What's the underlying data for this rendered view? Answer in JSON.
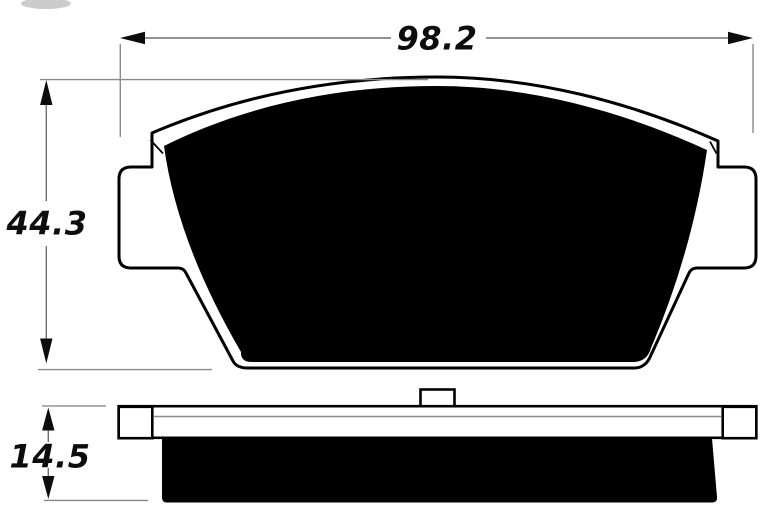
{
  "drawing": {
    "subject": "brake-pad-technical-drawing",
    "views": {
      "front": {
        "name": "pad front profile"
      },
      "side": {
        "name": "pad side profile"
      }
    },
    "dimensions": {
      "width": {
        "value": "98.2"
      },
      "height": {
        "value": "44.3"
      },
      "thickness": {
        "value": "14.5"
      }
    }
  },
  "colors": {
    "background": "#ffffff",
    "ink": "#000000",
    "plate_fill": "#ffffff",
    "dimension_line": "#6e6e6e",
    "extension_line": "#8a8a8a",
    "label_text": "#0d0d0d"
  }
}
